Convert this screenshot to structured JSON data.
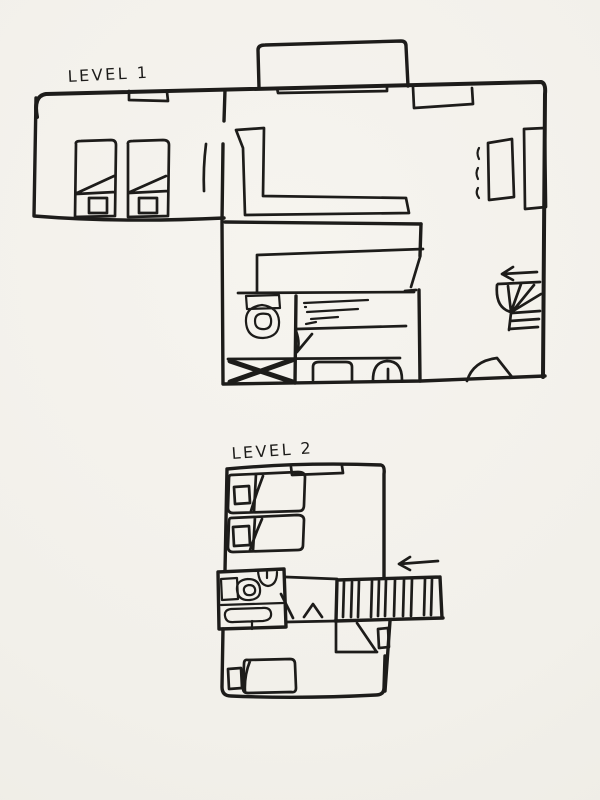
{
  "colors": {
    "paper": "#f2f0ea",
    "ink": "#1d1c1a"
  },
  "levels": {
    "level1": {
      "label": "LEVEL 1",
      "arrow_direction": "left"
    },
    "level2": {
      "label": "LEVEL 2",
      "arrow_direction": "left"
    }
  }
}
